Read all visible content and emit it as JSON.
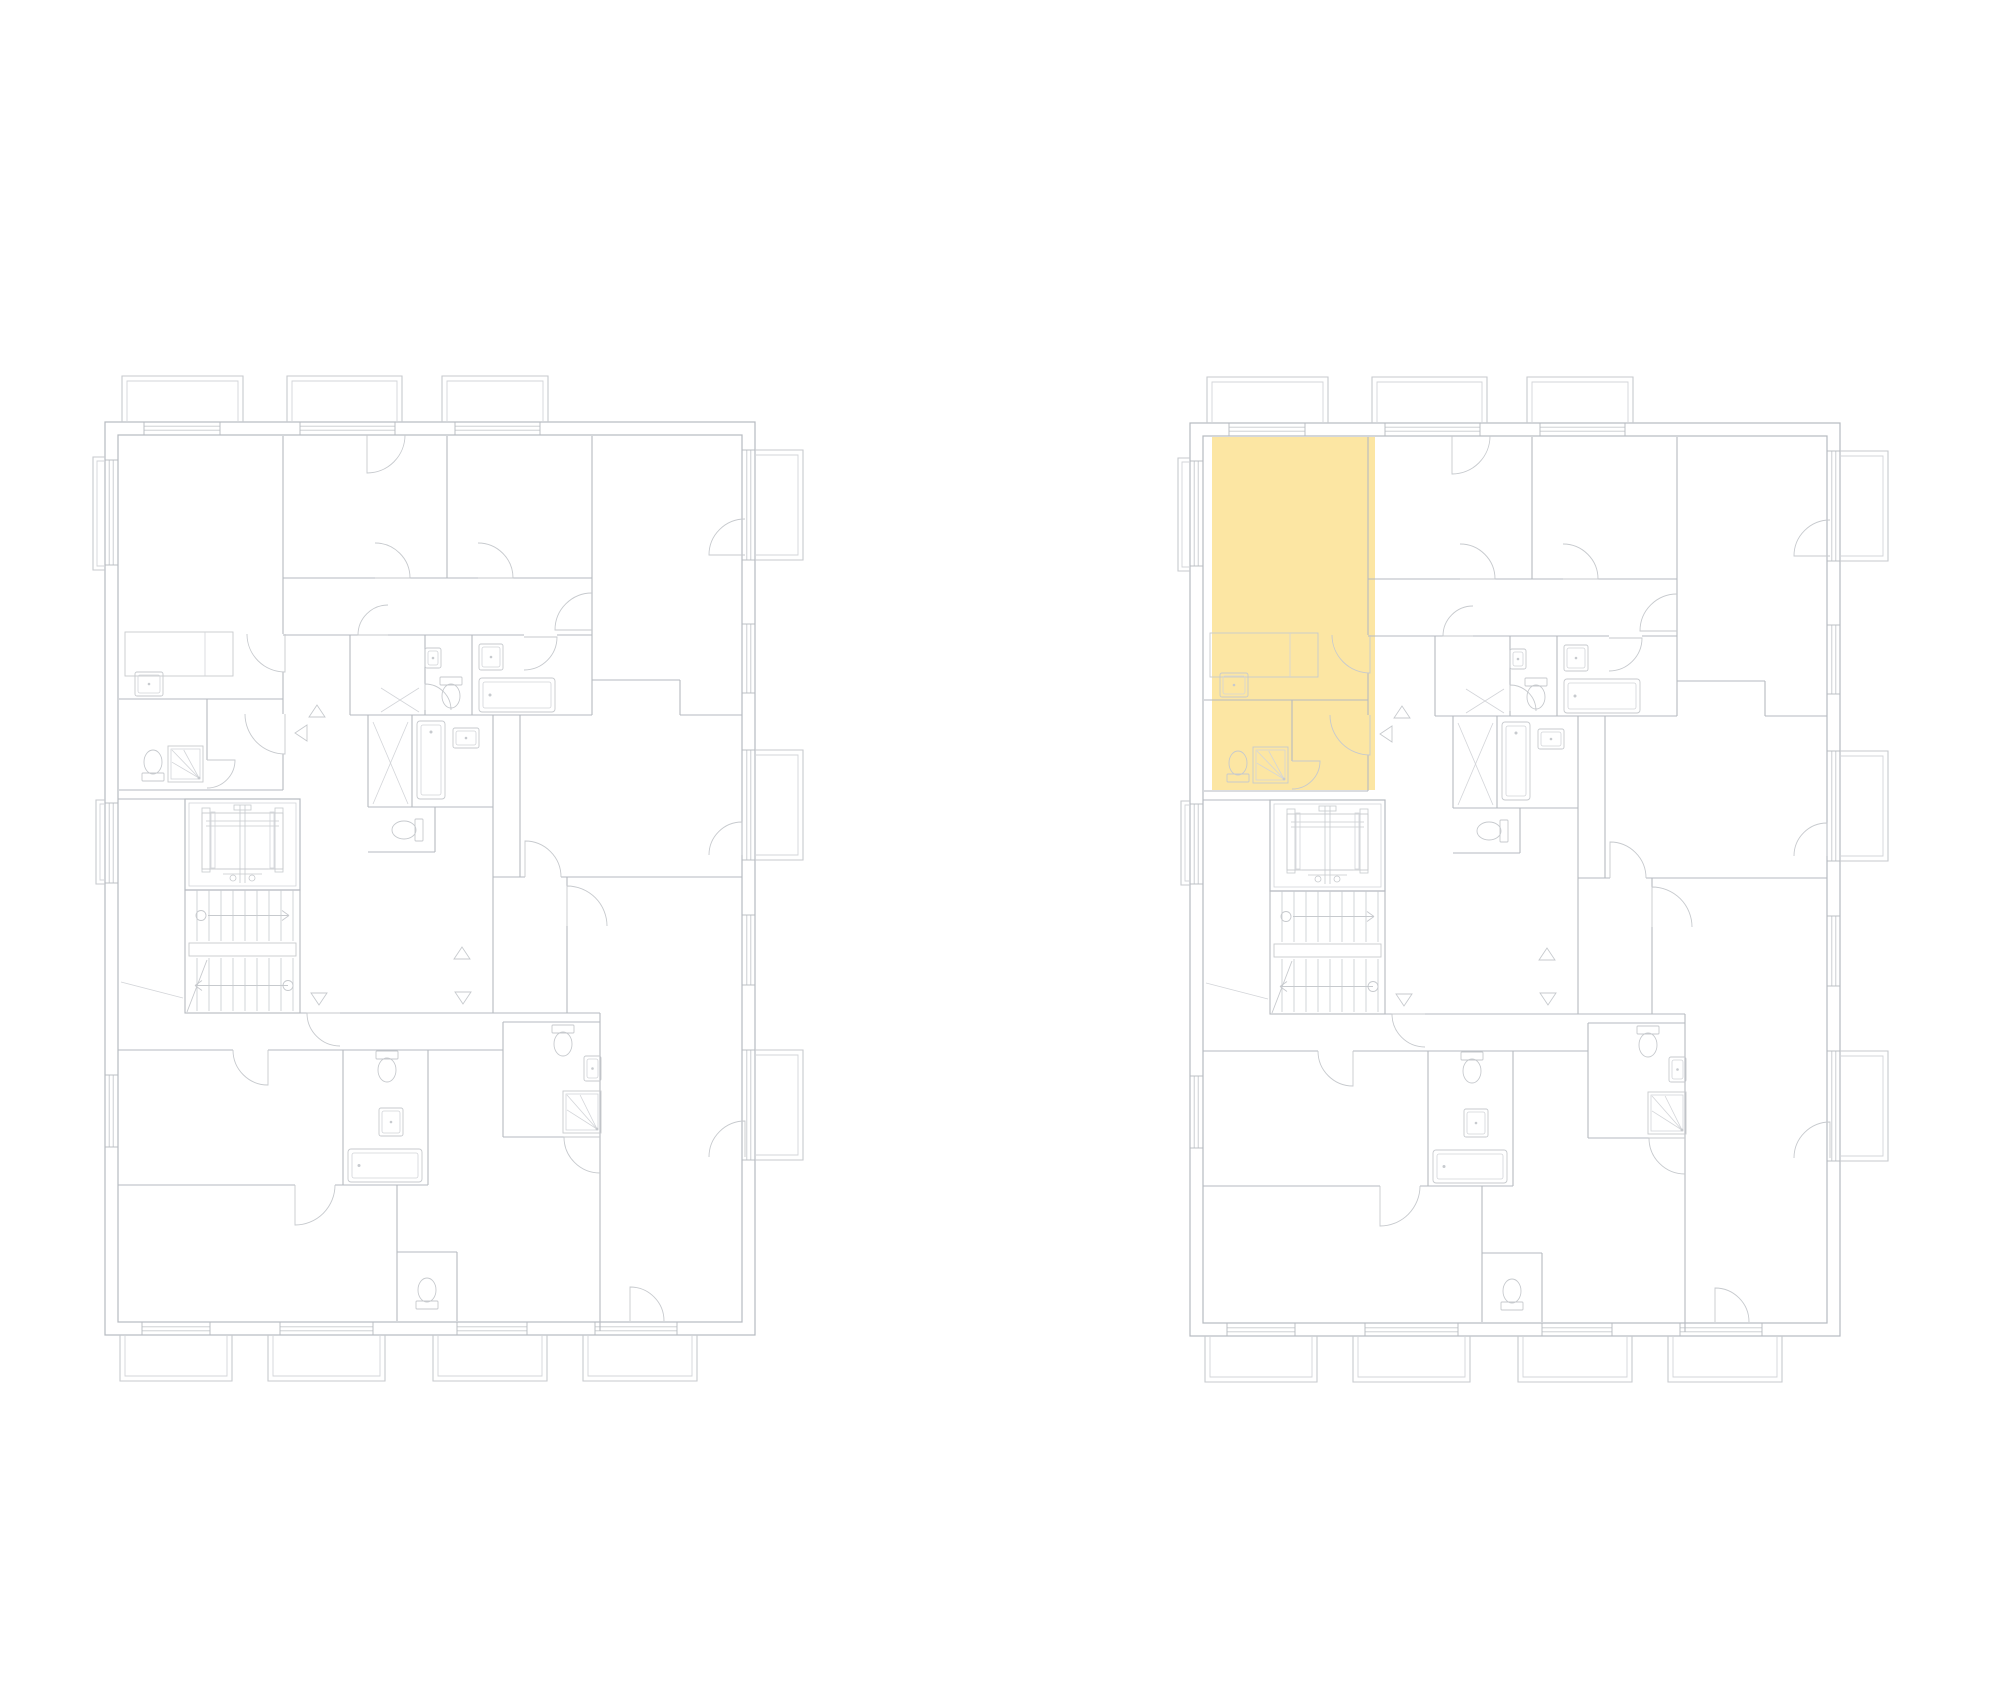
{
  "canvas": {
    "width": 2000,
    "height": 1700,
    "background": "#ffffff"
  },
  "colors": {
    "wall": "#b6bac0",
    "detail": "#c7cace",
    "soft": "#d3d5d9",
    "highlight_fill": "#fce6a3"
  },
  "plans": [
    {
      "name": "floor-plan-left",
      "x": 105,
      "y": 422,
      "highlighted_unit": false
    },
    {
      "name": "floor-plan-right",
      "x": 1190,
      "y": 423,
      "highlighted_unit": true
    }
  ],
  "highlight_unit_rect": [
    22,
    14,
    163,
    353
  ],
  "plan": {
    "width": 650,
    "height": 913,
    "outer": [
      [
        0,
        0,
        650,
        913
      ],
      [
        13,
        13,
        624,
        887
      ]
    ],
    "walls": [
      [
        178,
        14,
        178,
        212
      ],
      [
        178,
        250,
        178,
        292
      ],
      [
        178,
        332,
        178,
        368
      ],
      [
        14,
        368,
        178,
        368
      ],
      [
        14,
        277,
        178,
        277
      ],
      [
        102,
        277,
        102,
        338
      ],
      [
        342,
        14,
        342,
        156
      ],
      [
        487,
        14,
        487,
        293
      ],
      [
        178,
        156,
        270,
        156
      ],
      [
        305,
        156,
        373,
        156
      ],
      [
        408,
        156,
        487,
        156
      ],
      [
        178,
        213,
        419,
        213
      ],
      [
        452,
        213,
        487,
        213
      ],
      [
        245,
        213,
        245,
        293
      ],
      [
        320,
        213,
        320,
        262
      ],
      [
        320,
        288,
        320,
        293
      ],
      [
        367,
        213,
        367,
        293
      ],
      [
        245,
        293,
        487,
        293
      ],
      [
        575,
        293,
        637,
        293
      ],
      [
        263,
        293,
        263,
        385
      ],
      [
        307,
        293,
        307,
        385
      ],
      [
        388,
        293,
        388,
        591
      ],
      [
        263,
        385,
        388,
        385
      ],
      [
        263,
        430,
        330,
        430
      ],
      [
        330,
        385,
        330,
        430
      ],
      [
        487,
        258,
        575,
        258
      ],
      [
        575,
        258,
        575,
        293
      ],
      [
        415,
        293,
        415,
        455
      ],
      [
        388,
        455,
        420,
        455
      ],
      [
        456,
        455,
        637,
        455
      ],
      [
        462,
        455,
        462,
        464
      ],
      [
        462,
        504,
        462,
        591
      ],
      [
        235,
        591,
        495,
        591
      ],
      [
        80,
        591,
        202,
        591
      ],
      [
        13,
        377,
        80,
        377
      ],
      [
        398,
        600,
        398,
        715
      ],
      [
        398,
        600,
        495,
        600
      ],
      [
        398,
        715,
        459,
        715
      ],
      [
        495,
        591,
        495,
        909
      ],
      [
        13,
        628,
        128,
        628
      ],
      [
        163,
        628,
        398,
        628
      ],
      [
        238,
        628,
        238,
        763
      ],
      [
        323,
        628,
        323,
        763
      ],
      [
        13,
        763,
        190,
        763
      ],
      [
        230,
        763,
        323,
        763
      ],
      [
        292,
        763,
        292,
        899
      ],
      [
        292,
        830,
        352,
        830
      ],
      [
        352,
        830,
        352,
        899
      ]
    ],
    "windows": [
      {
        "edge": "top",
        "from": 39,
        "to": 115
      },
      {
        "edge": "top",
        "from": 195,
        "to": 290
      },
      {
        "edge": "top",
        "from": 350,
        "to": 435
      },
      {
        "edge": "bottom",
        "from": 37,
        "to": 105
      },
      {
        "edge": "bottom",
        "from": 175,
        "to": 268
      },
      {
        "edge": "bottom",
        "from": 352,
        "to": 422
      },
      {
        "edge": "bottom",
        "from": 490,
        "to": 572
      },
      {
        "edge": "right",
        "from": 28,
        "to": 138
      },
      {
        "edge": "right",
        "from": 202,
        "to": 271
      },
      {
        "edge": "right",
        "from": 328,
        "to": 438
      },
      {
        "edge": "right",
        "from": 493,
        "to": 563
      },
      {
        "edge": "right",
        "from": 628,
        "to": 738
      },
      {
        "edge": "left",
        "from": 38,
        "to": 143
      },
      {
        "edge": "left",
        "from": 381,
        "to": 461
      },
      {
        "edge": "left",
        "from": 653,
        "to": 725
      }
    ],
    "balconies": [
      {
        "edge": "top",
        "from": 17,
        "to": 138,
        "depth": 46
      },
      {
        "edge": "top",
        "from": 182,
        "to": 297,
        "depth": 46
      },
      {
        "edge": "top",
        "from": 337,
        "to": 443,
        "depth": 46
      },
      {
        "edge": "bottom",
        "from": 15,
        "to": 127,
        "depth": 46
      },
      {
        "edge": "bottom",
        "from": 163,
        "to": 280,
        "depth": 46
      },
      {
        "edge": "bottom",
        "from": 328,
        "to": 442,
        "depth": 46
      },
      {
        "edge": "bottom",
        "from": 478,
        "to": 592,
        "depth": 46
      },
      {
        "edge": "right",
        "from": 28,
        "to": 138,
        "depth": 48
      },
      {
        "edge": "right",
        "from": 328,
        "to": 438,
        "depth": 48
      },
      {
        "edge": "right",
        "from": 628,
        "to": 738,
        "depth": 48
      },
      {
        "edge": "left",
        "from": 35,
        "to": 148,
        "depth": 12
      },
      {
        "edge": "left",
        "from": 378,
        "to": 462,
        "depth": 9
      }
    ],
    "doors": [
      [
        180,
        212,
        38,
        90,
        180
      ],
      [
        180,
        292,
        40,
        90,
        180
      ],
      [
        102,
        338,
        28,
        0,
        90
      ],
      [
        270,
        156,
        35,
        0,
        -90
      ],
      [
        373,
        156,
        35,
        0,
        -90
      ],
      [
        262,
        13,
        38,
        90,
        0
      ],
      [
        283,
        213,
        30,
        180,
        270
      ],
      [
        487,
        208,
        37,
        180,
        270
      ],
      [
        419,
        215,
        33,
        0,
        90
      ],
      [
        320,
        288,
        26,
        270,
        360
      ],
      [
        640,
        133,
        36,
        180,
        270
      ],
      [
        420,
        455,
        36,
        270,
        360
      ],
      [
        462,
        504,
        40,
        270,
        360
      ],
      [
        637,
        433,
        33,
        270,
        180
      ],
      [
        525,
        899,
        34,
        270,
        360
      ],
      [
        190,
        763,
        40,
        90,
        0
      ],
      [
        163,
        628,
        35,
        90,
        180
      ],
      [
        495,
        715,
        36,
        180,
        90
      ],
      [
        235,
        591,
        33,
        180,
        90
      ],
      [
        640,
        735,
        36,
        270,
        180
      ]
    ],
    "triangles": [
      [
        212,
        290,
        "up"
      ],
      [
        197,
        311,
        "left"
      ],
      [
        357,
        532,
        "up"
      ],
      [
        214,
        576,
        "down"
      ],
      [
        358,
        575,
        "down"
      ]
    ],
    "elevator": {
      "x": 80,
      "y": 377,
      "w": 115,
      "h": 91
    },
    "stairs": {
      "x": 80,
      "y": 468,
      "w": 115,
      "h": 123,
      "landing_y": 519,
      "landing_h": 17,
      "tread_step": 12
    },
    "fixtures": {
      "beds": [
        [
          20,
          210,
          108,
          44,
          100
        ]
      ],
      "sinks": [
        [
          30,
          250,
          28,
          24
        ],
        [
          374,
          222,
          24,
          26
        ],
        [
          320,
          226,
          16,
          20
        ],
        [
          348,
          306,
          26,
          20
        ],
        [
          274,
          686,
          24,
          28
        ],
        [
          479,
          634,
          17,
          25
        ]
      ],
      "tubs": [
        [
          374,
          256,
          76,
          34,
          "h"
        ],
        [
          243,
          727,
          74,
          33,
          "h"
        ],
        [
          312,
          299,
          28,
          78,
          "v"
        ]
      ],
      "showers": [
        [
          63,
          324,
          35,
          36
        ],
        [
          458,
          669,
          38,
          42
        ]
      ],
      "toilets": [
        [
          48,
          340,
          "n"
        ],
        [
          346,
          274,
          "s"
        ],
        [
          299,
          408,
          "e"
        ],
        [
          282,
          648,
          "s"
        ],
        [
          322,
          868,
          "n"
        ],
        [
          458,
          622,
          "s"
        ]
      ],
      "hatches": [
        [
          276,
          266,
          314,
          290
        ],
        [
          276,
          290,
          314,
          266
        ],
        [
          268,
          300,
          303,
          382
        ],
        [
          268,
          382,
          303,
          300
        ],
        [
          16,
          560,
          78,
          576
        ]
      ]
    }
  }
}
